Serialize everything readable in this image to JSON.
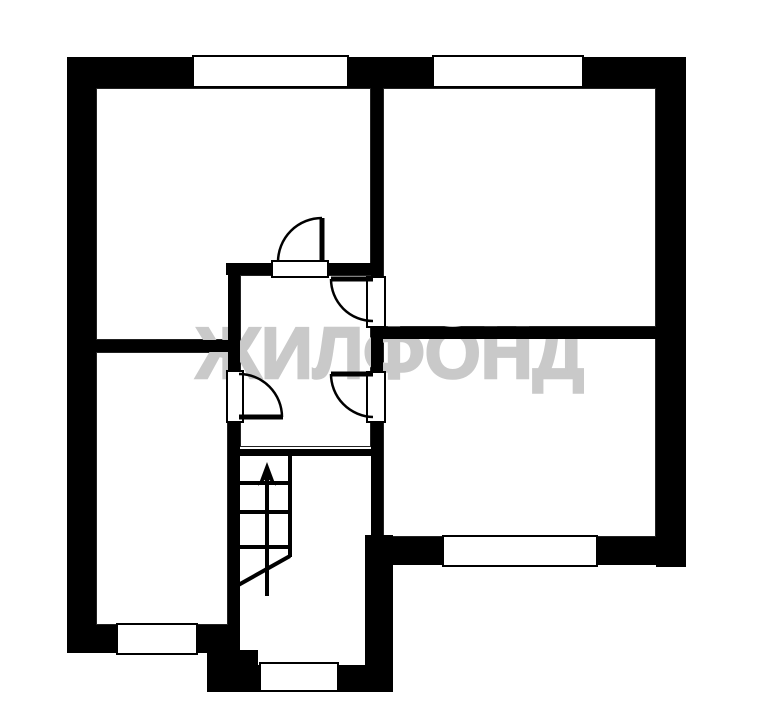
{
  "watermark": {
    "text": "ЖИЛФОНД"
  },
  "colors": {
    "walls": "#000000",
    "background": "#ffffff",
    "watermark_gray": "#c9c9c9"
  },
  "plan_summary": {
    "type": "apartment-floor-plan",
    "rooms_count": 4,
    "has_central_hallway": true,
    "interior_doors_count": 4,
    "windows_count": 5,
    "stairs": {
      "present": true,
      "arrow_direction": "up",
      "treads_count": 3
    }
  }
}
